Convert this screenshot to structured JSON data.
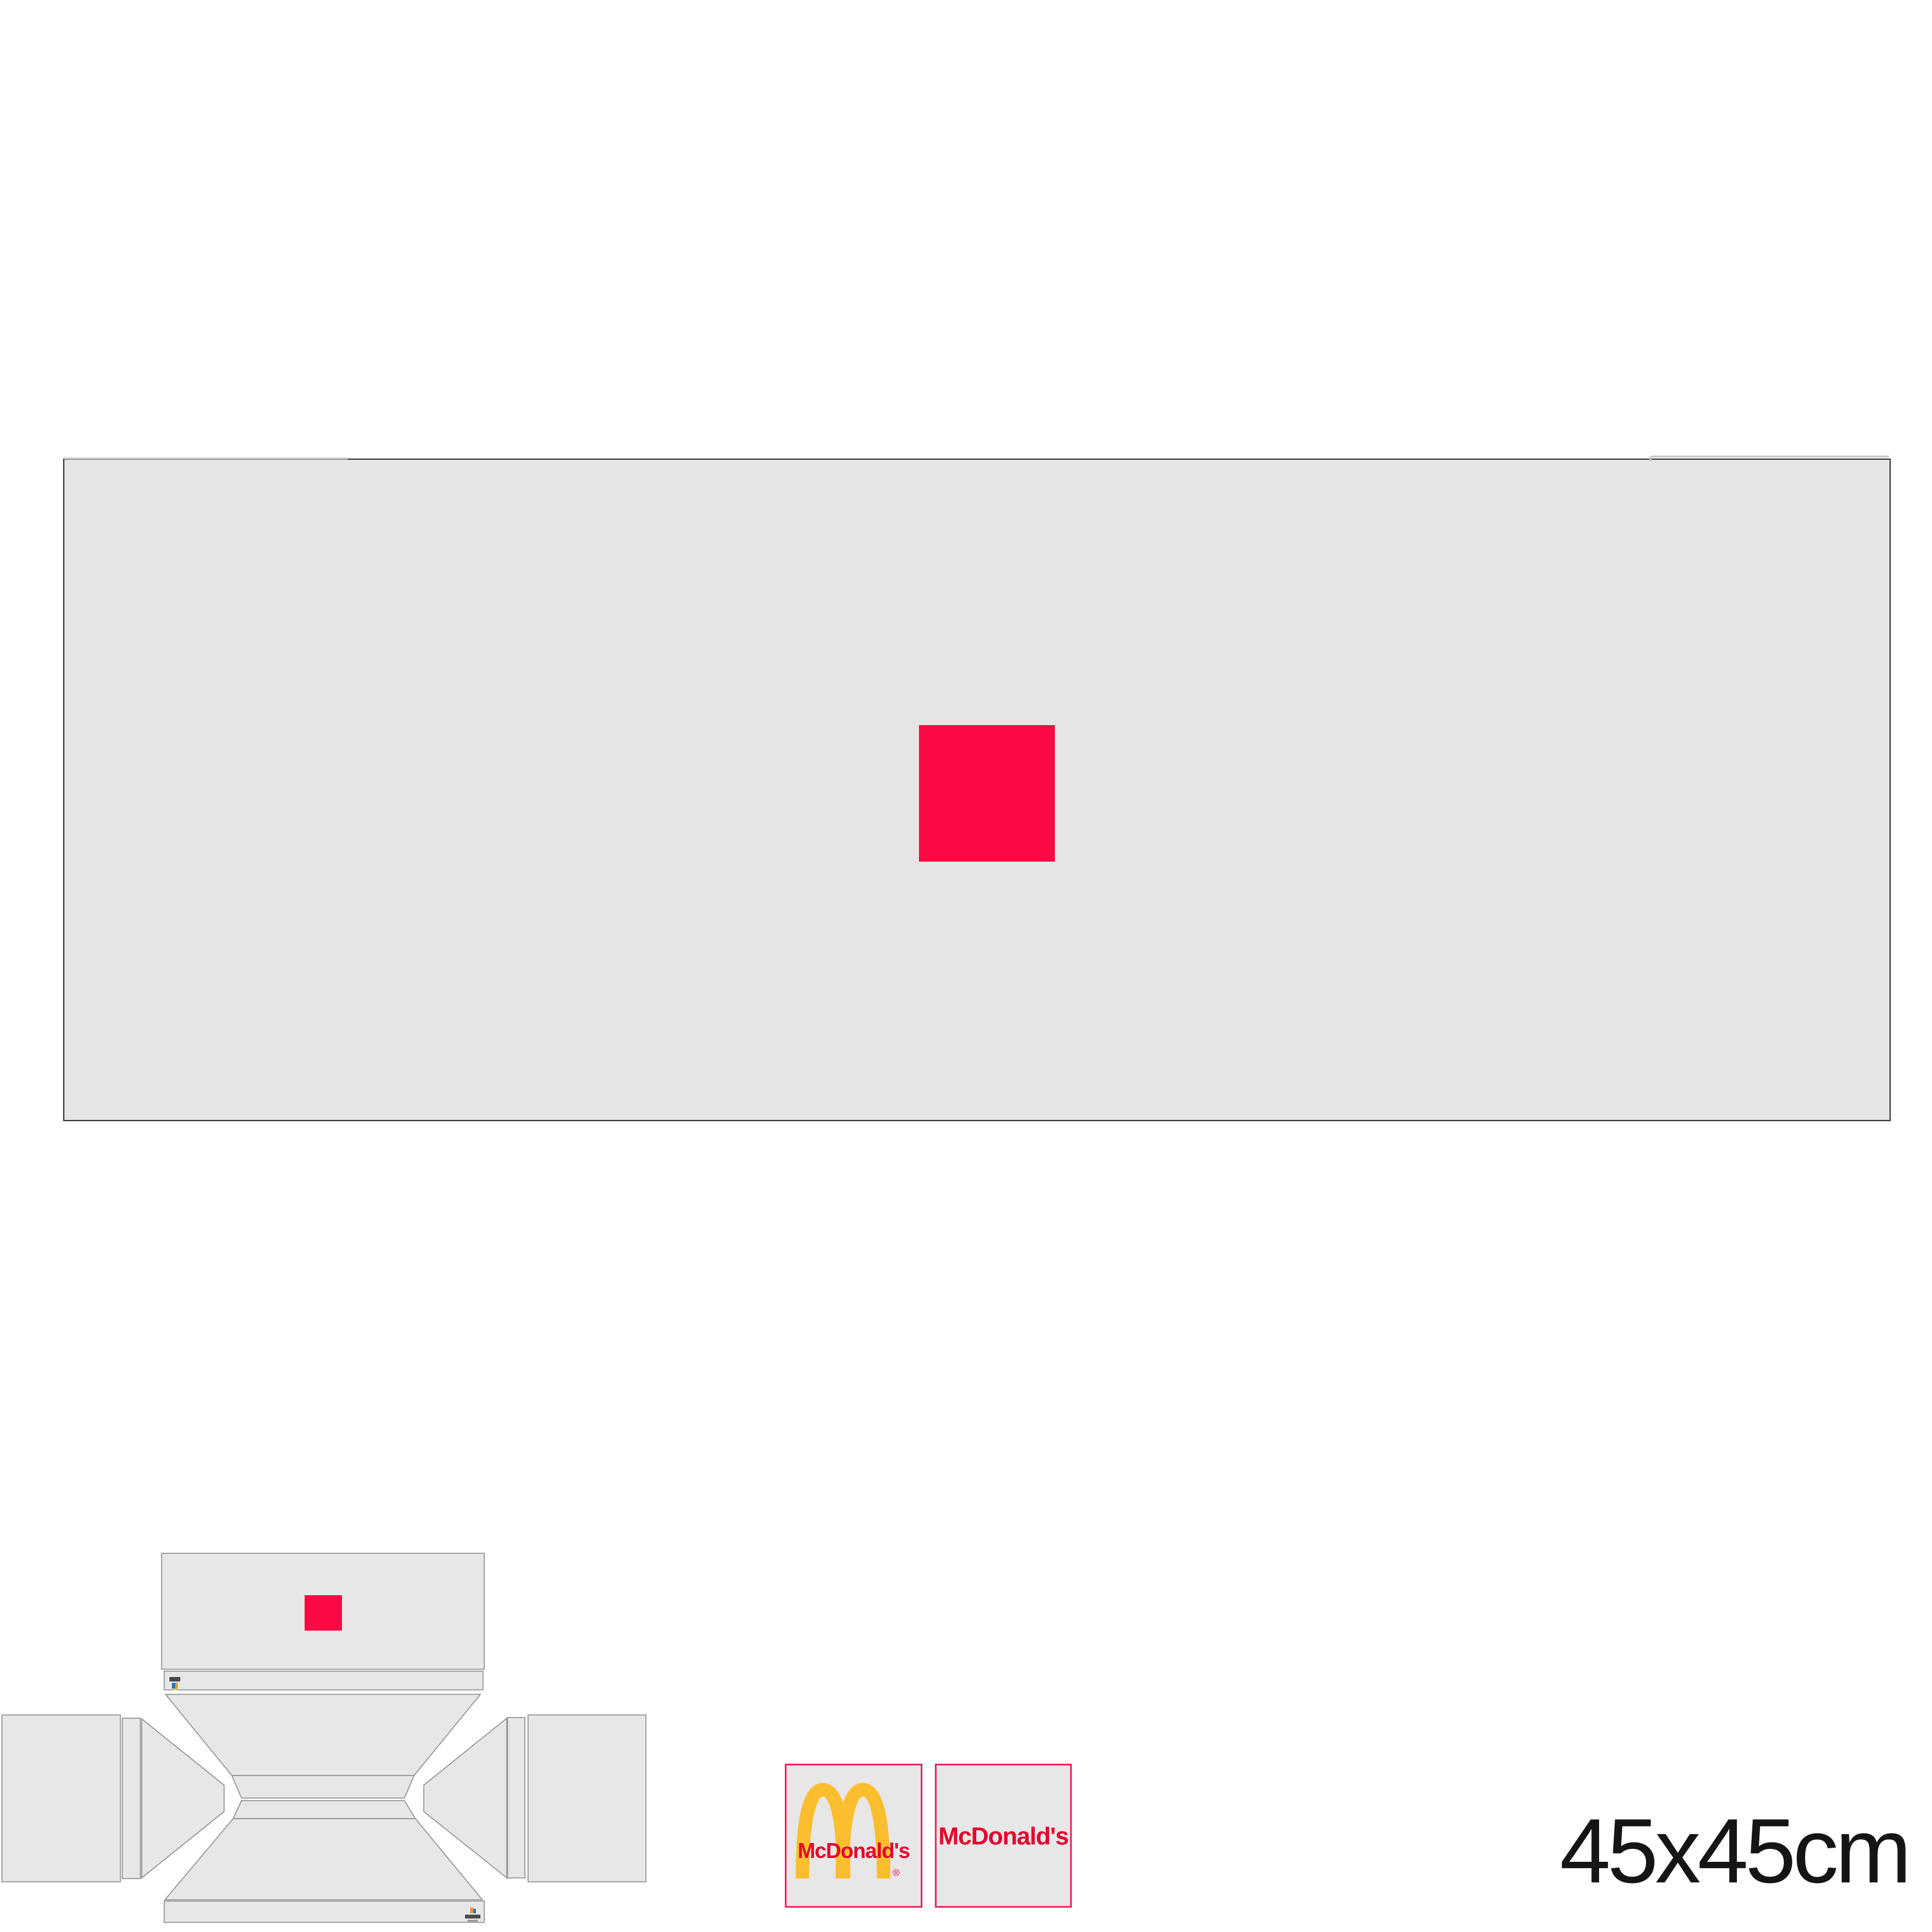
{
  "labels": {
    "size": "45x45cm",
    "brand_left": "McDonald's",
    "brand_right": "McDonald's",
    "registered_mark": "®"
  },
  "colors": {
    "background": "#FFFFFF",
    "panel": "#E6E5E6",
    "panel_border": "#3F3F3F",
    "die_fill": "#E8E7E8",
    "die_stroke": "#909090",
    "accent_red": "#FB0A46",
    "swatch_border": "#EE1550",
    "mcdonalds_red": "#E4002B",
    "arches_gold": "#FBBE2F",
    "text_color": "#151515",
    "light_edge": "#C6C6C6",
    "mark_dark": "#4A4A4A",
    "mark_gray": "#9A9A9A",
    "mark_blue": "#2E6FB5",
    "mark_orange": "#E8962E",
    "mark_yellow": "#D8D04A"
  },
  "icons": {
    "golden_arches": "golden-arches-icon",
    "printer_mark_top": "printer-mark-icon",
    "printer_mark_bottom": "printer-mark-icon"
  }
}
